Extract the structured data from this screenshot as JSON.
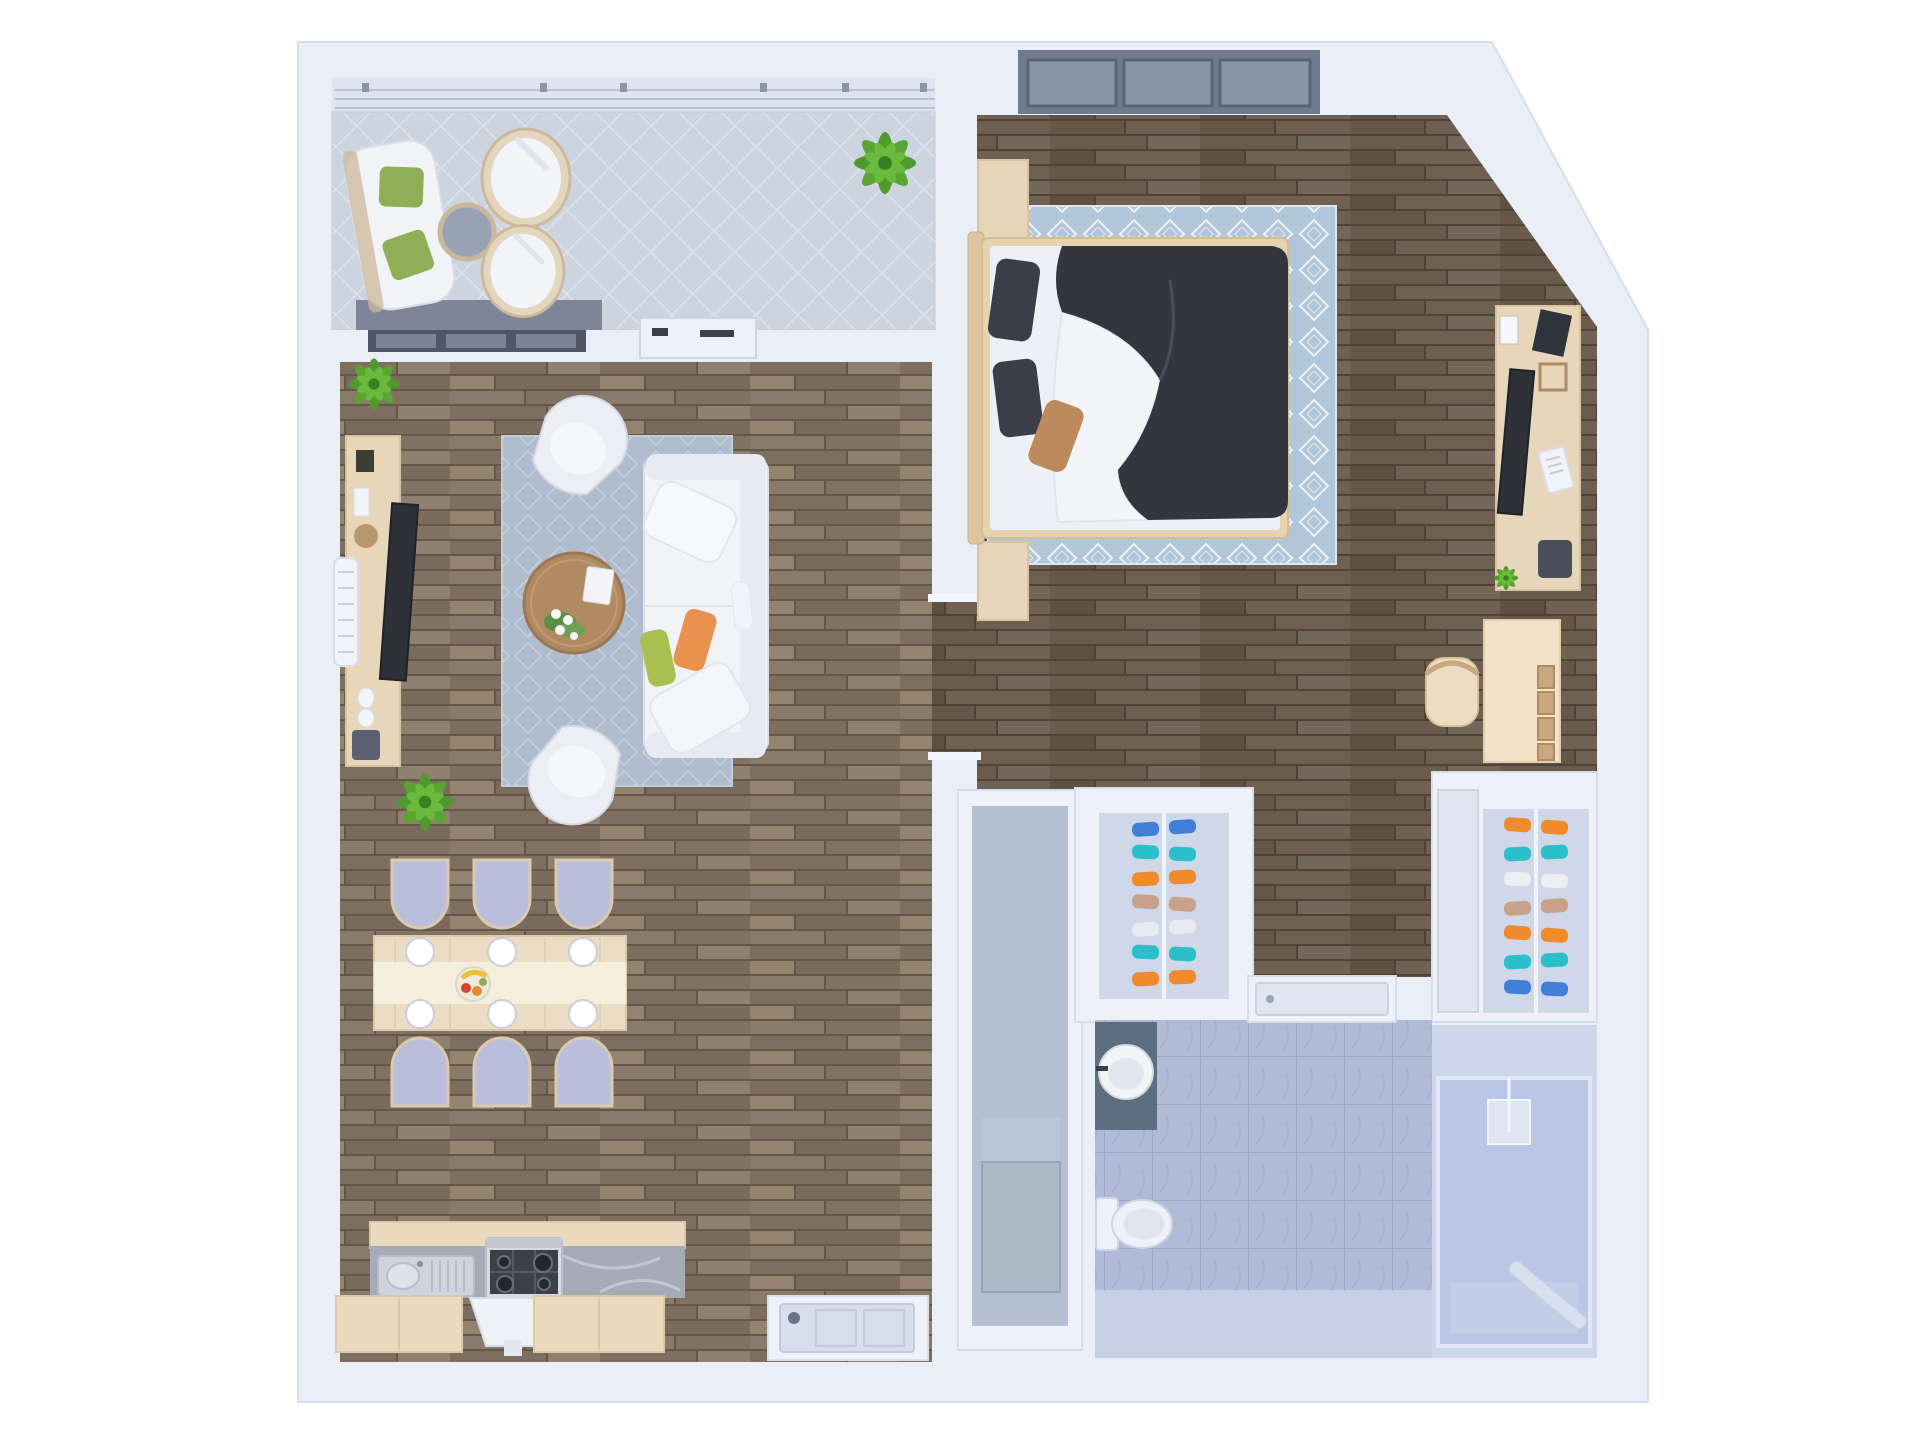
{
  "meta": {
    "title": "3D rendered top-view floor plan of a one-bedroom apartment",
    "view": "top-down 3D render",
    "no_visible_text": true
  },
  "palette": {
    "outside": "#ffffff",
    "wall": "#e9eef7",
    "wall_edge": "#d6ddeb",
    "balcony_rail": "#dde4ef",
    "rail_mark": "#8b94a6",
    "slider_header": "#7d8699",
    "slider_frame": "#4f5666",
    "window_frame": "#707a8e",
    "window_pane": "#8b95a8",
    "sofa": "#f1f3f7",
    "cushion_shadow": "#e7eaf1",
    "pillow_orange": "#e8924d",
    "pillow_green": "#a9c050",
    "pillow_olive": "#8fae55",
    "pillow_tan": "#bd8a5e",
    "coffee_table": "#b08a63",
    "chair_upholstery": "#b9bfda",
    "dining_table": "#ecdcc3",
    "table_runner": "#f4efdc",
    "cabinet_wood": "#ead9bd",
    "furniture_wood": "#e7d6ba",
    "desk_wood": "#f0e1c8",
    "bed_wood": "#e7d3ad",
    "counter_marble": "#a4aab6",
    "steel": "#cfd4dc",
    "stove": "#3c4047",
    "duvet": "#34363f",
    "sheet": "#f3f4f7",
    "mattress": "#eef0f5",
    "tv_dark": "#2e3138",
    "radiator": "#f1f3f8",
    "vanity": "#5c6f80",
    "toilet": "#eef1f7",
    "shower_glass": "#b5c3e4",
    "bath_floor_light": "#c6cfe6",
    "utility_floor": "#b4bfd2",
    "utility_box": "#aeb9c8",
    "door_leaf": "#dfe5f1",
    "front_door": "#d8dfec",
    "plant": "#4f9a2c",
    "closet_glass": "#cfd8e8"
  },
  "rooms": [
    {
      "id": "balcony",
      "label": "balcony",
      "floor": "light gray tile"
    },
    {
      "id": "living-dining",
      "label": "living and dining room",
      "floor": "wood planks"
    },
    {
      "id": "kitchen",
      "label": "kitchen nook",
      "floor": "wood planks"
    },
    {
      "id": "bedroom",
      "label": "bedroom",
      "floor": "dark wood planks"
    },
    {
      "id": "hallway",
      "label": "hallway",
      "floor": "dark wood planks"
    },
    {
      "id": "utility",
      "label": "utility corridor",
      "floor": "gray"
    },
    {
      "id": "bathroom",
      "label": "bathroom",
      "floor": "blue marble tile"
    },
    {
      "id": "shower",
      "label": "glass shower",
      "floor": "blue marble tile"
    }
  ],
  "furniture": {
    "balcony": [
      "loveseat with two olive cushions",
      "round gray side table",
      "two round wicker chairs",
      "potted plant"
    ],
    "living": [
      "media sideboard with TV",
      "wall radiator",
      "patterned area rug",
      "two tub armchairs",
      "round wood coffee table with flowers",
      "three-seat white sofa with orange and green pillows",
      "two potted plants"
    ],
    "dining": [
      "six-seat wood dining table with runner and fruit bowl",
      "six upholstered chairs",
      "six place settings"
    ],
    "kitchen": [
      "stainless sink with drainboard",
      "four-burner gas stove",
      "range hood",
      "marble counter",
      "wood base cabinets"
    ],
    "bedroom": [
      "double bed with dark duvet and white sheet",
      "two wood nightstands",
      "diamond-pattern blue rug",
      "media dresser with TV",
      "desk with cubby shelf and chair",
      "triple window"
    ],
    "closets": [
      "glass shoe cabinet in hallway",
      "glass shoe cabinet near bathroom"
    ],
    "bathroom": [
      "round basin on gray vanity",
      "toilet",
      "glass shower enclosure"
    ],
    "utility": [
      "gray appliance box"
    ]
  },
  "closets": {
    "middle": {
      "shoes": [
        "#3f7fd8",
        "#2bbfc9",
        "#ef8a2d",
        "#c9a18b",
        "#e8e9ee",
        "#2bbfc9",
        "#ef8a2d"
      ]
    },
    "right": {
      "shoes": [
        "#ef8a2d",
        "#2bbfc9",
        "#eceef2",
        "#c9a18b",
        "#ef8a2d",
        "#2bbfc9",
        "#3f7fd8"
      ]
    }
  }
}
